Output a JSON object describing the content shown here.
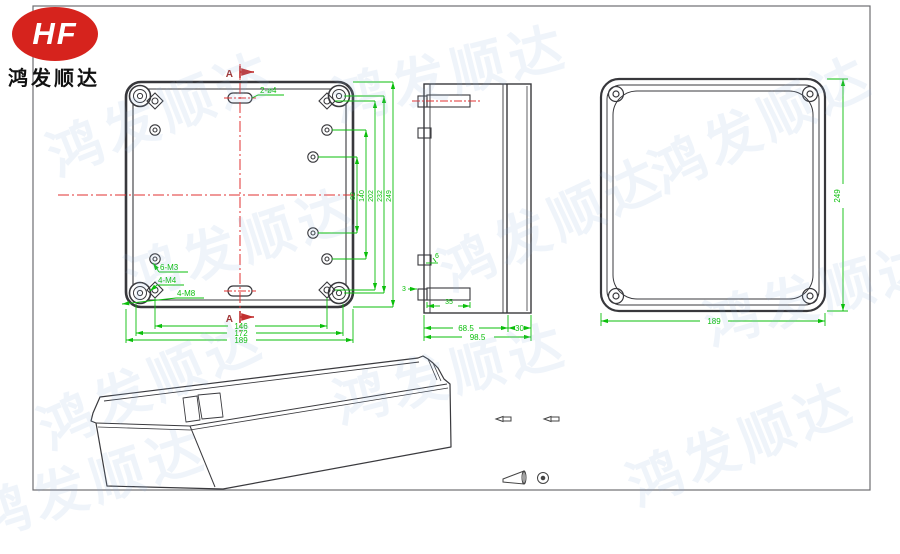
{
  "logo": {
    "brand": "HF",
    "company": "鸿发顺达"
  },
  "watermark": {
    "text": "鸿发顺达"
  },
  "front_view": {
    "slot_label": "2-ø4",
    "section_top": "A",
    "section_bottom": "A",
    "vertical_dims": [
      "82",
      "140",
      "202",
      "232",
      "249"
    ],
    "bottom_dims": [
      "146",
      "172",
      "189"
    ],
    "thread_labels": [
      "6-M3",
      "4-M4",
      "4-M8"
    ]
  },
  "side_view": {
    "dim_body_depth": "68.5",
    "dim_lid_depth": "30",
    "dim_total_depth": "98.5",
    "dim_boss_width": "35",
    "dim_gap": "3",
    "dim_boss": "6"
  },
  "back_view": {
    "dim_height": "249",
    "dim_width": "189"
  },
  "colors": {
    "dimension_green": "#0bbf0b",
    "centerline_red": "#e03030",
    "line_dark": "#38383c",
    "logo_red": "#d6231d",
    "watermark_blue": "#c5dcef"
  }
}
